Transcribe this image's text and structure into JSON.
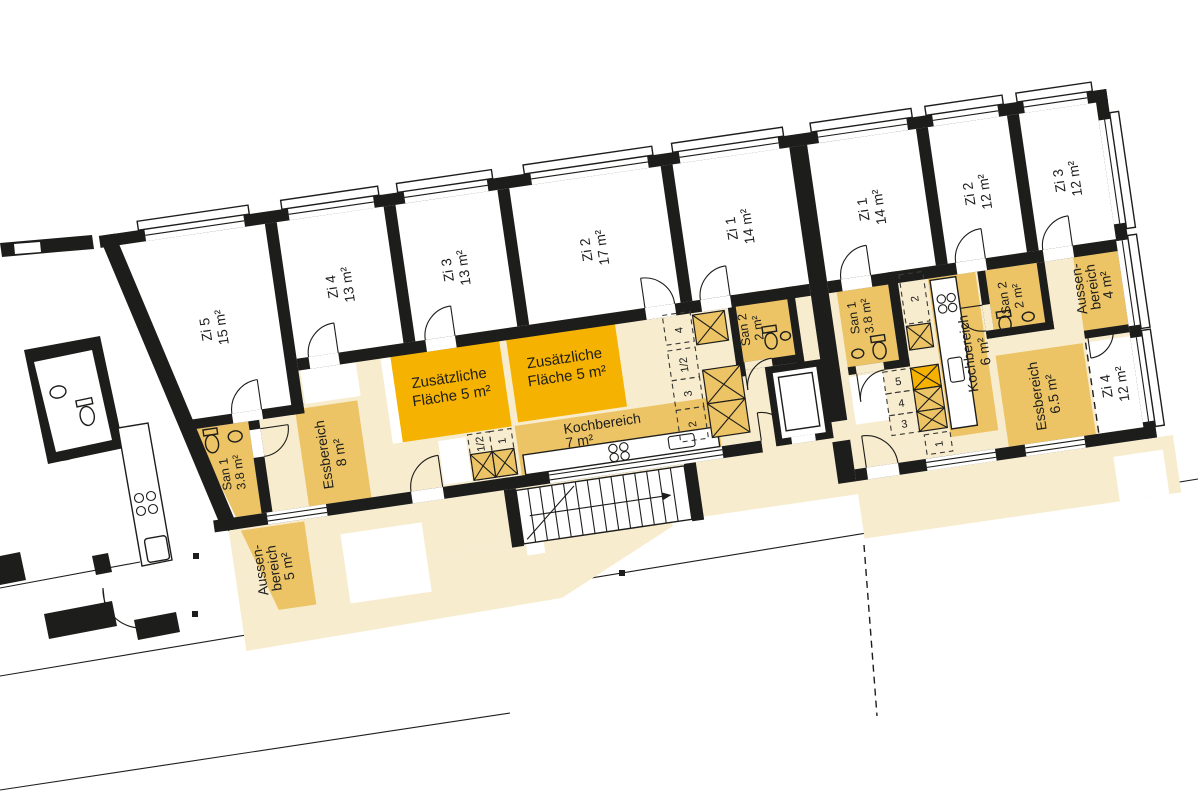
{
  "colors": {
    "wall": "#1d1d1b",
    "common_area": "#f8ecce",
    "highlight": "#ecc466",
    "accent": "#f6b200",
    "label_text": "#1d1d1b"
  },
  "left": {
    "zi5": {
      "name": "Zi 5",
      "area": "15 m²"
    },
    "zi4": {
      "name": "Zi 4",
      "area": "13 m²"
    },
    "zi3": {
      "name": "Zi 3",
      "area": "13 m²"
    },
    "zi2": {
      "name": "Zi 2",
      "area": "17 m²"
    },
    "zi1": {
      "name": "Zi 1",
      "area": "14 m²"
    },
    "san1": {
      "name": "San 1",
      "area": "3.8 m²"
    },
    "san2": {
      "name": "San 2",
      "area": "2 m²"
    },
    "ess": {
      "name": "Essbereich",
      "area": "8 m²"
    },
    "koch": {
      "name": "Kochbereich",
      "area": "7 m²"
    },
    "zusatz1": {
      "line1": "Zusätzliche",
      "line2": "Fläche 5 m²"
    },
    "zusatz2": {
      "line1": "Zusätzliche",
      "line2": "Fläche 5 m²"
    },
    "aussen": {
      "line1": "Aussen-",
      "line2": "bereich",
      "line3": "5 m²"
    },
    "cells": [
      "4",
      "1/2",
      "3",
      "2"
    ],
    "kcells": [
      "1/2",
      "1"
    ]
  },
  "right": {
    "zi1": {
      "name": "Zi 1",
      "area": "14 m²"
    },
    "zi2": {
      "name": "Zi 2",
      "area": "12 m²"
    },
    "zi3": {
      "name": "Zi 3",
      "area": "12 m²"
    },
    "zi4": {
      "name": "Zi 4",
      "area": "12 m²"
    },
    "san1": {
      "name": "San 1",
      "area": "3.8 m²"
    },
    "san2": {
      "name": "San 2",
      "area": "2 m²"
    },
    "koch": {
      "name": "Kochbereich",
      "area": "6 m²"
    },
    "ess": {
      "name": "Essbereich",
      "area": "6.5 m²"
    },
    "aussen": {
      "line1": "Aussen-",
      "line2": "bereich",
      "line3": "4 m²"
    },
    "cells": [
      "5",
      "4",
      "3"
    ],
    "cell_one": "1",
    "cell_two": "2"
  }
}
